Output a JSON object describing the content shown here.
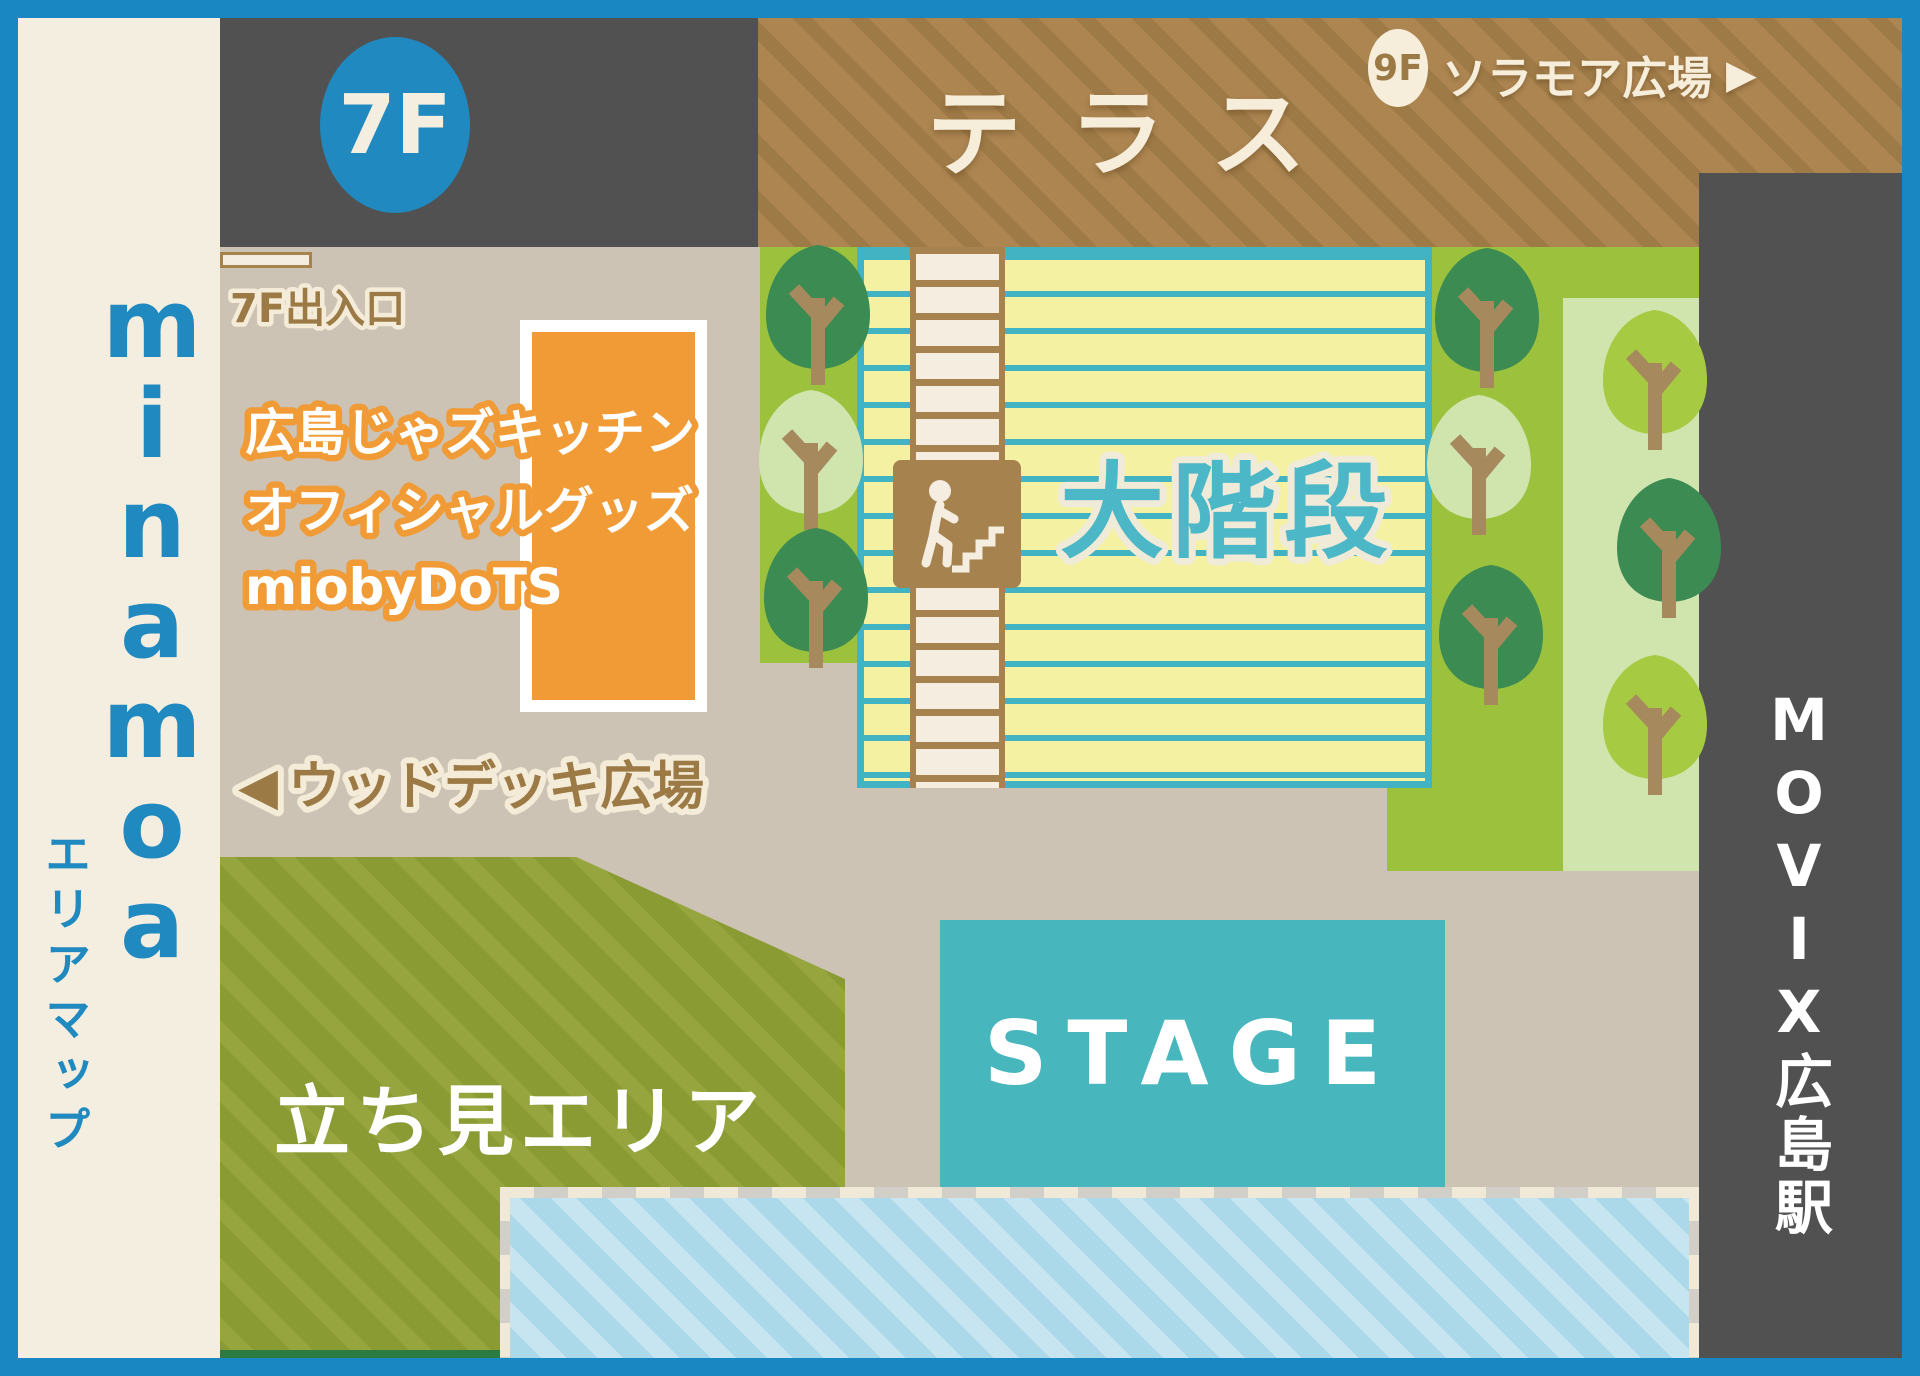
{
  "map": {
    "brand": "minamoa",
    "area_map_label": "エリアマップ",
    "floor_badge": "7F",
    "terrace": {
      "label": "テラス",
      "link": {
        "floor": "9F",
        "label": "ソラモア広場",
        "arrow": "▶"
      }
    },
    "entrance": {
      "label": "7F出入口"
    },
    "goods": {
      "lines": [
        "広島じゃズキッチン",
        "オフィシャルグッズ",
        "miobyDoTS"
      ]
    },
    "wooddeck": {
      "arrow": "◀",
      "label": "ウッドデッキ広場"
    },
    "staircase": {
      "label": "大階段"
    },
    "standing": {
      "label": "立ち見エリア"
    },
    "stage": {
      "label": "STAGE"
    },
    "movix": {
      "label": "MOVIX広島駅"
    }
  },
  "colors": {
    "frame_blue": "#1987c2",
    "accent_blue": "#2089bf",
    "dark_gray": "#515151",
    "tan": "#ccc3b4",
    "cream": "#f4eee1",
    "terrace_brown": "#ac8551",
    "lawn_green": "#9cc23d",
    "tree_dark": "#3c8b52",
    "tree_pale": "#d0e4ae",
    "tree_medium": "#a6ca41",
    "stair_yellow": "#f4f2a2",
    "stair_teal": "#41b3c2",
    "step_cream": "#f4ede0",
    "step_brown": "#a5824e",
    "grand_stair_teal": "#4cb7c6",
    "orange": "#f19b37",
    "olive": "#8b9b34",
    "stage_teal": "#47b7bd",
    "audience_blue": "#abd9ea",
    "label_brown": "#9c7a45"
  }
}
